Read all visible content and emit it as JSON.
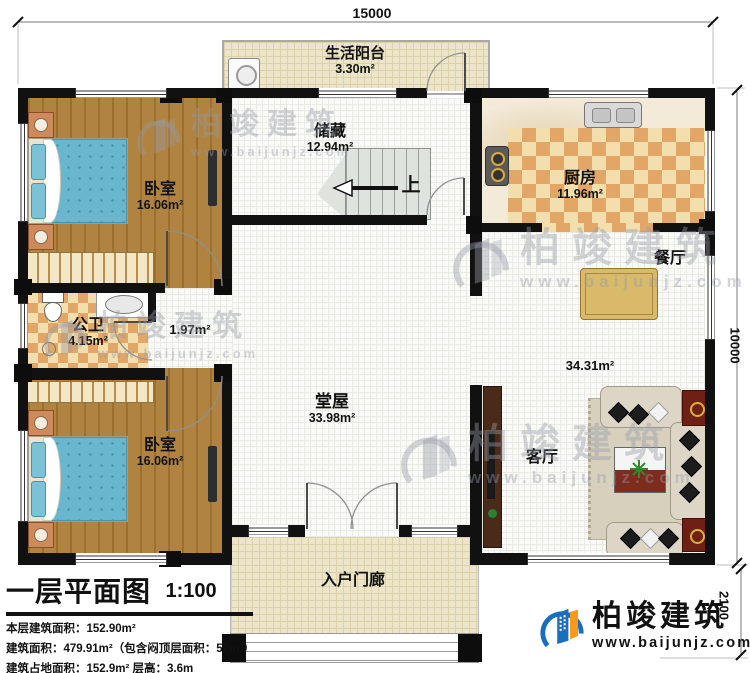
{
  "dimensions": {
    "top_width": "15000",
    "right_height": "10000",
    "porch_depth": "2100"
  },
  "rooms": {
    "balcony": {
      "name": "生活阳台",
      "area": "3.30m²"
    },
    "storage": {
      "name": "储藏",
      "area": "12.94m²"
    },
    "kitchen": {
      "name": "厨房",
      "area": "11.96m²"
    },
    "bedroom_top": {
      "name": "卧室",
      "area": "16.06m²"
    },
    "bathroom": {
      "name": "公卫",
      "area": "4.15m²"
    },
    "corridor": {
      "area": "1.97m²"
    },
    "hall": {
      "name": "堂屋",
      "area": "33.98m²"
    },
    "dining": {
      "name": "餐厅"
    },
    "living": {
      "name": "客厅",
      "area": "34.31m²"
    },
    "bedroom_bottom": {
      "name": "卧室",
      "area": "16.06m²"
    },
    "porch": {
      "name": "入户门廊"
    },
    "stairs": {
      "up_label": "上"
    }
  },
  "title_block": {
    "title": "一层平面图",
    "scale": "1:100",
    "stats": [
      "本层建筑面积：152.90m²",
      "建筑面积：479.91m²（包含闷顶层面积：57m²）",
      "建筑占地面积：152.9m²  层高：3.6m"
    ]
  },
  "brand": {
    "name": "柏竣建筑",
    "website": "www.baijunjz.com"
  },
  "watermark": {
    "name": "柏竣建筑",
    "website": "www.baijunjz.com"
  },
  "colors": {
    "wall": "#111111",
    "brand_blue": "#1a6fbd",
    "brand_orange": "#f59a1d",
    "bed_blue": "#68b7ce",
    "wood": "#a87c38",
    "tile_orange": "#e2a766",
    "tile_cream": "#f3dfae"
  }
}
